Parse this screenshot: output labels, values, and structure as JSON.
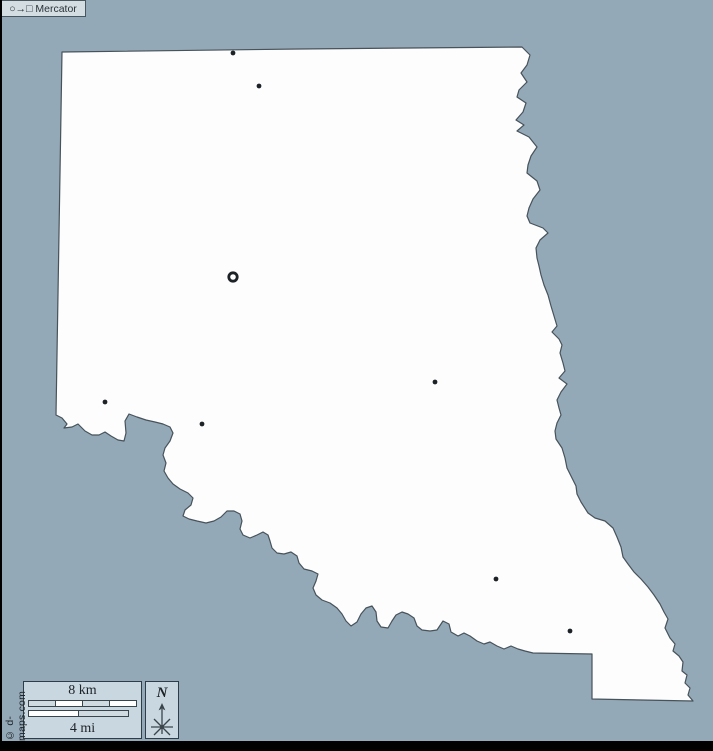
{
  "colors": {
    "background": "#94a9b7",
    "map_fill": "#fdfdfd",
    "map_stroke": "#47525a",
    "box_fill": "#c9d8e0",
    "box_border": "#2f3e46",
    "bar_shaded": "#cfdbe0",
    "bar_white": "#ffffff",
    "ink": "#1d2226",
    "frame": "#000000"
  },
  "map": {
    "outline_path": "M62,52 L300,49 L522,47 L530,55 L527,65 L521,73 L527,82 L519,90 L517,97 L526,103 L523,112 L516,120 L524,125 L517,131 L529,137 L537,147 L531,156 L528,165 L527,173 L537,181 L540,190 L533,199 L529,208 L527,216 L530,223 L543,228 L548,233 L540,240 L536,248 L537,258 L539,266 L541,275 L544,285 L548,295 L551,306 L554,316 L557,326 L552,332 L559,339 L562,345 L560,353 L563,363 L565,371 L559,378 L567,384 L561,392 L557,400 L559,408 L561,415 L557,423 L555,431 L556,439 L562,448 L565,458 L567,468 L572,478 L576,486 L577,494 L581,502 L588,513 L595,518 L605,521 L613,528 L617,537 L621,547 L623,557 L628,564 L634,572 L641,579 L648,587 L654,595 L660,604 L664,612 L668,619 L665,628 L670,638 L675,644 L673,651 L679,656 L683,662 L682,671 L687,675 L685,683 L690,688 L688,695 L693,701 L592,699 L592,654 L533,653 L525,651 L518,649 L511,646 L504,649 L497,646 L490,642 L484,644 L477,641 L470,636 L464,633 L458,636 L451,632 L449,624 L443,621 L437,630 L430,631 L422,630 L417,626 L414,618 L408,614 L402,612 L396,615 L392,621 L388,628 L381,627 L377,621 L376,612 L372,606 L366,608 L361,614 L357,622 L351,626 L346,621 L342,614 L337,608 L330,603 L322,600 L316,595 L313,588 L316,581 L318,574 L312,571 L304,569 L299,563 L297,556 L291,552 L284,554 L277,553 L272,548 L270,541 L268,535 L263,532 L257,535 L250,538 L243,535 L240,529 L242,521 L240,514 L234,511 L227,511 L221,517 L214,521 L206,523 L197,521 L189,519 L183,516 L185,510 L191,505 L193,498 L188,493 L180,489 L173,484 L168,478 L164,471 L166,463 L163,455 L165,448 L170,441 L173,433 L170,427 L163,424 L155,422 L146,420 L137,417 L129,414 L125,421 L126,433 L124,441 L118,440 L111,436 L105,432 L99,435 L92,435 L85,431 L78,424 L72,427 L64,428 L67,424 L62,418 L56,415 Z",
    "markers": [
      {
        "type": "dot",
        "x": 233,
        "y": 53,
        "r": 2.4
      },
      {
        "type": "dot",
        "x": 259,
        "y": 86,
        "r": 2.4
      },
      {
        "type": "seat",
        "x": 233,
        "y": 277,
        "r": 4.2
      },
      {
        "type": "dot",
        "x": 435,
        "y": 382,
        "r": 2.4
      },
      {
        "type": "dot",
        "x": 105,
        "y": 402,
        "r": 2.4
      },
      {
        "type": "dot",
        "x": 202,
        "y": 424,
        "r": 2.4
      },
      {
        "type": "dot",
        "x": 496,
        "y": 579,
        "r": 2.4
      },
      {
        "type": "dot",
        "x": 570,
        "y": 631,
        "r": 2.4
      }
    ]
  },
  "scale_box": {
    "km_label": "8 km",
    "mi_label": "4 mi",
    "km_segments": [
      "shaded",
      "white",
      "shaded",
      "white"
    ],
    "mi_segments": [
      "white",
      "shaded"
    ]
  },
  "north_box": {
    "label": "N"
  },
  "projection_box": {
    "symbols": "○→□",
    "label": "Mercator"
  },
  "copyright": "© d-maps.com"
}
